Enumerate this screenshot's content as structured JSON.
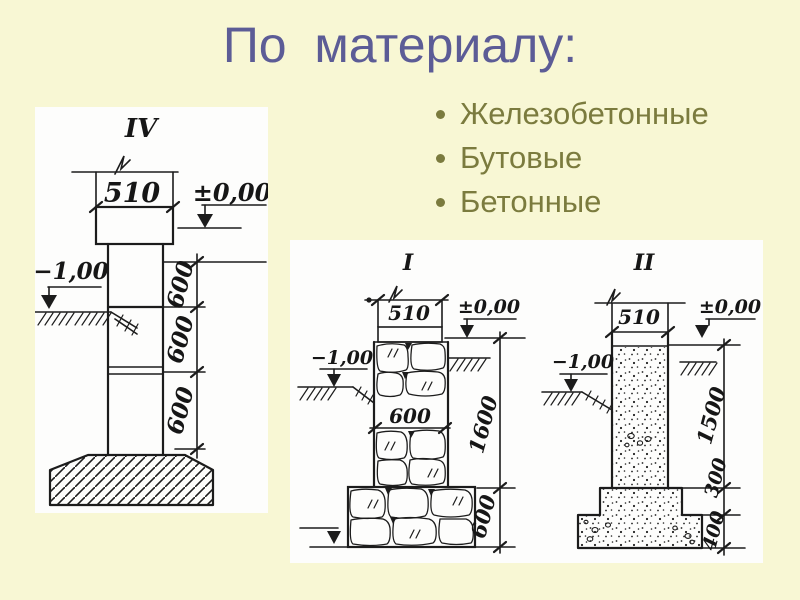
{
  "title": "По  материалу:",
  "bullets": {
    "items": [
      "Железобетонные",
      "Бутовые",
      "Бетонные"
    ]
  },
  "colors": {
    "background": "#f8f7d4",
    "title_text": "#5c5c96",
    "bullet_text": "#7b7b3e",
    "panel": "#fdfdfc",
    "ink": "#1c1c1c"
  },
  "drawings": {
    "iv": {
      "label": "IV",
      "top_width": "510",
      "level_zero": "±0,00",
      "level_minus": "−1,00",
      "segments": [
        "600",
        "600",
        "600"
      ]
    },
    "i": {
      "label": "I",
      "top_width": "510",
      "level_zero": "±0,00",
      "level_minus": "−1,00",
      "mid_width": "600",
      "total_height": "1600",
      "footing_height": "600"
    },
    "ii": {
      "label": "II",
      "top_width": "510",
      "level_zero": "±0,00",
      "level_minus": "−1,00",
      "wall_height": "1500",
      "step_height": "300",
      "footing_height": "400"
    }
  }
}
